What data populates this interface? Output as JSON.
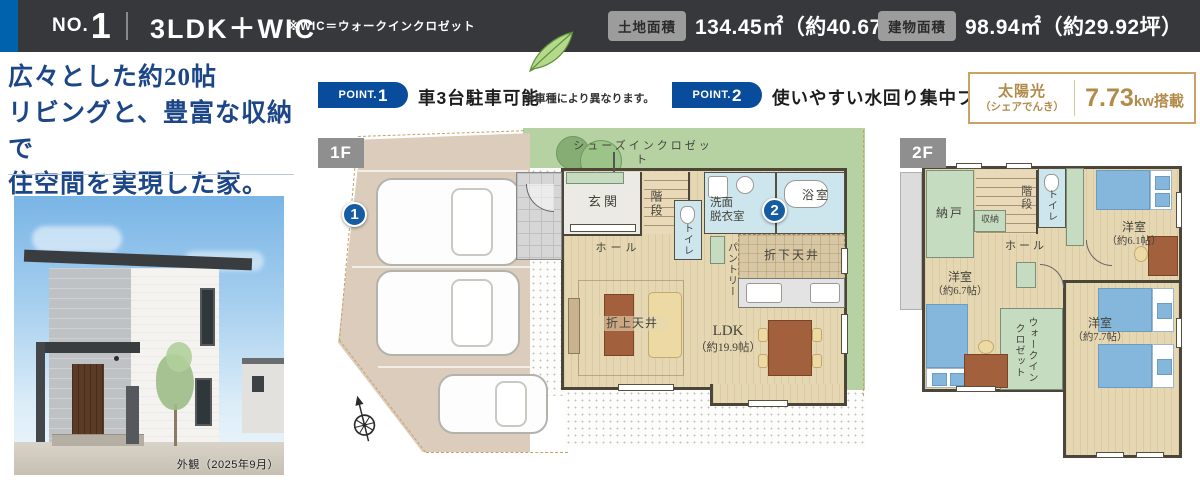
{
  "colors": {
    "header_bg": "#36383b",
    "accent_blue": "#0061ad",
    "point_badge_blue": "#0a4c9c",
    "catch_copy_blue": "#1c4687",
    "solar_gold": "#b28b4a",
    "lawn_green": "#b6d2a2",
    "marker_blue": "#155ca2"
  },
  "header": {
    "no_label": "NO.",
    "no_number": "1",
    "layout": "3LDK＋WIC",
    "layout_note": "※WIC＝ウォークインクロゼット",
    "land": {
      "label": "土地面積",
      "value": "134.45㎡（約40.67坪）"
    },
    "building": {
      "label": "建物面積",
      "value": "98.94㎡（約29.92坪）"
    }
  },
  "catchcopy": {
    "line1": "広々とした約20帖",
    "line2": "リビングと、豊富な収納で",
    "line3": "住空間を実現した家。"
  },
  "photo": {
    "caption": "外観（2025年9月）"
  },
  "points": [
    {
      "badge": "POINT.",
      "num": "1",
      "text": "車3台駐車可能",
      "note": "※車種により異なります。"
    },
    {
      "badge": "POINT.",
      "num": "2",
      "text": "使いやすい水回り集中プラン",
      "note": ""
    }
  ],
  "solar": {
    "label1": "太陽光",
    "label2": "（シェアでんき）",
    "value_num": "7.73",
    "value_unit": "kw搭載"
  },
  "plan1f": {
    "tag": "1F",
    "marker1": "1",
    "marker2": "2",
    "shoes_closet": "シューズインクロゼット",
    "genkan": "玄関",
    "stairs": "階段",
    "toilet": "トイレ",
    "washroom": "洗面\n脱衣室",
    "bath": "浴室",
    "hall": "ホール",
    "pantry": "パントリー",
    "down_ceiling": "折下天井",
    "up_ceiling": "折上天井",
    "ldk_name": "LDK",
    "ldk_size": "（約19.9帖）"
  },
  "plan2f": {
    "tag": "2F",
    "nando": "納戸",
    "shuno": "収納",
    "stairs": "階段",
    "toilet": "トイレ",
    "hall": "ホール",
    "bedroom1_name": "洋室",
    "bedroom1_size": "（約6.1帖）",
    "bedroom2_name": "洋室",
    "bedroom2_size": "（約6.7帖）",
    "bedroom3_name": "洋室",
    "bedroom3_size": "（約7.7帖）",
    "wic": "ウォークインクロゼット"
  }
}
